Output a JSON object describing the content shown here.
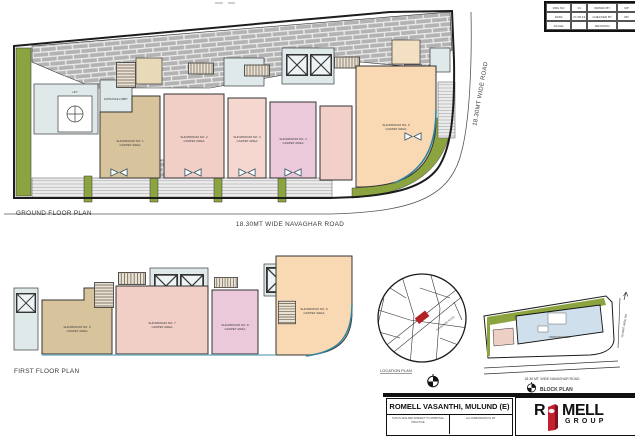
{
  "drawing": {
    "ground_floor": {
      "label": "GROUND FLOOR PLAN",
      "road_label": "18.30MT WIDE NAVAGHAR ROAD",
      "side_road_label": "18.30MT WIDE ROAD",
      "lobby_label": "ENTRANCE LOBBY",
      "lift_label": "LIFT",
      "units": [
        {
          "name": "SHOWROOM NO. 1",
          "area": "CARPET AREA"
        },
        {
          "name": "SHOWROOM NO. 2",
          "area": "CARPET AREA"
        },
        {
          "name": "SHOWROOM NO. 3",
          "area": "CARPET AREA"
        },
        {
          "name": "SHOWROOM NO. 4",
          "area": "CARPET AREA"
        },
        {
          "name": "SHOWROOM NO. 5",
          "area": "CARPET AREA"
        }
      ]
    },
    "first_floor": {
      "label": "FIRST FLOOR PLAN",
      "units": [
        {
          "name": "SHOWROOM NO. 6",
          "area": "CARPET AREA"
        },
        {
          "name": "SHOWROOM NO. 7",
          "area": "CARPET AREA"
        },
        {
          "name": "SHOWROOM NO. 8",
          "area": "CARPET AREA"
        },
        {
          "name": "SHOWROOM NO. 9",
          "area": "CARPET AREA"
        }
      ]
    },
    "location_plan": {
      "label": "LOCATION PLAN",
      "road_hint": "NAVAGHAR ROAD"
    },
    "block_plan": {
      "label": "BLOCK PLAN",
      "road_label": "18.30 MT. WIDE NAVAGHAR ROAD",
      "side_road_label": "18.30MT WIDE RD",
      "footprint_label": "PROPOSED BLDG."
    }
  },
  "title_table": {
    "rows": [
      [
        "DRG NO",
        "01",
        "DRAWN BY",
        "MP"
      ],
      [
        "DATE",
        "27-08-19",
        "CHECKED BY",
        "RD"
      ],
      [
        "SCALE",
        "",
        "REVISION",
        ""
      ]
    ]
  },
  "title_block": {
    "project": "ROMELL VASANTHI, MULUND (E)",
    "note_left": "THIS PLANS ARE SUBJECT TO APPROVAL PRACTICE",
    "note_right": "ALL DIMENSIONS IN MT.",
    "logo": {
      "r": "R",
      "mell": "MELL",
      "group": "GROUP"
    }
  },
  "colors": {
    "accent_red": "#c21f2f",
    "green": "#8ca440",
    "teal": "#2e84a0"
  }
}
